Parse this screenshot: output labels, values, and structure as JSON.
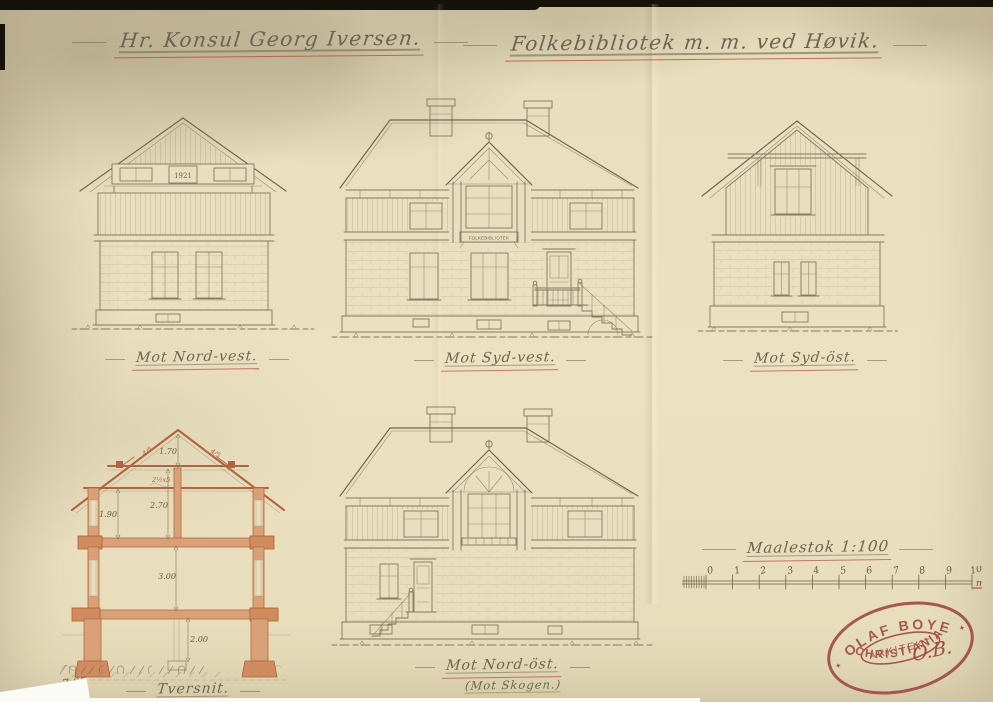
{
  "titles": {
    "client": "Hr. Konsul Georg Iversen.",
    "project": "Folkebibliotek m. m. ved Høvik."
  },
  "elevations": {
    "northwest": {
      "label": "Mot Nord-vest.",
      "date_plaque": "1921"
    },
    "southwest": {
      "label": "Mot Syd-vest.",
      "sign": "FOLKEBIBLIOTEK"
    },
    "southeast": {
      "label": "Mot Syd-öst."
    },
    "northeast": {
      "label": "Mot Nord-öst.",
      "sublabel": "(Mot Skogen.)"
    }
  },
  "section": {
    "label": "Tversnit.",
    "dimensions": {
      "ridge_height": "1.70",
      "rafter_left": "4/5",
      "rafter_right": "4/5",
      "timber_note": "2½x5",
      "loft_side_height": "1.90",
      "loft_center_height": "2.70",
      "main_floor_height": "3.00",
      "basement_height": "2.00"
    },
    "pencil_note": "7,65"
  },
  "scale_bar": {
    "label": "Maalestok 1:100",
    "ticks": [
      "0",
      "1",
      "2",
      "3",
      "4",
      "5",
      "6",
      "7",
      "8",
      "9",
      "10"
    ],
    "unit": "m"
  },
  "stamp": {
    "name": "OLAF BOYE",
    "title": "ARKITEKT",
    "city": "CHRISTIANIA",
    "initials": "O.B."
  },
  "colors": {
    "paper": "#e9dfc0",
    "ink": "#84785f",
    "accent_red": "#b44f38",
    "section_wall": "#daa078",
    "stamp_red": "#9c4640"
  }
}
